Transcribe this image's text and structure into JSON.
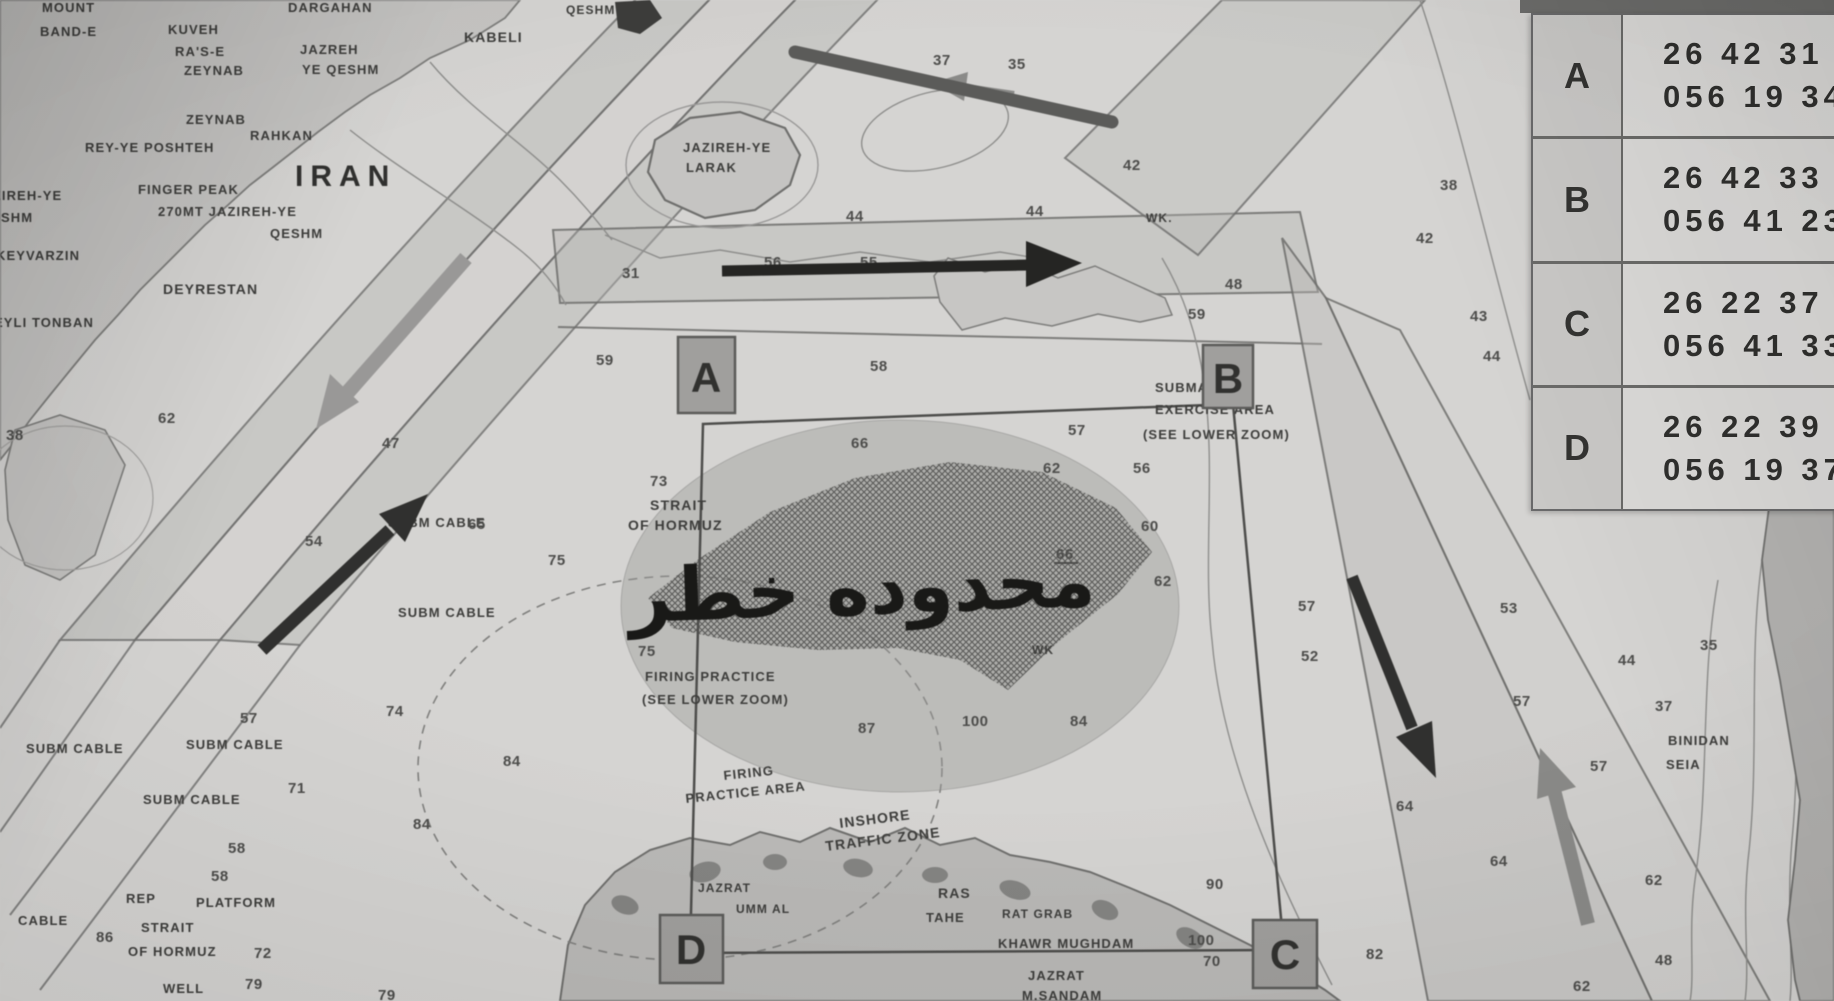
{
  "meta": {
    "description": "Photographed nautical chart, Strait of Hormuz, with danger-area overlay and coordinate table"
  },
  "coordinate_table": {
    "rows": [
      {
        "point": "A",
        "line1": "26 42 31",
        "line2": "056 19 34"
      },
      {
        "point": "B",
        "line1": "26 42 33",
        "line2": "056 41 23"
      },
      {
        "point": "C",
        "line1": "26 22 37",
        "line2": "056 41 33"
      },
      {
        "point": "D",
        "line1": "26 22 39",
        "line2": "056 19 37"
      }
    ]
  },
  "map": {
    "danger_text": "محدوده خطر",
    "corner_markers": [
      {
        "letter": "A"
      },
      {
        "letter": "B"
      },
      {
        "letter": "C"
      },
      {
        "letter": "D"
      }
    ],
    "place_labels": [
      {
        "t": "MOUNT",
        "x": 42,
        "y": 12,
        "s": 13
      },
      {
        "t": "BAND-E",
        "x": 40,
        "y": 36,
        "s": 13
      },
      {
        "t": "DARGAHAN",
        "x": 288,
        "y": 12,
        "s": 13
      },
      {
        "t": "KUVEH",
        "x": 168,
        "y": 34,
        "s": 13
      },
      {
        "t": "RA'S-E",
        "x": 175,
        "y": 56,
        "s": 13
      },
      {
        "t": "ZEYNAB",
        "x": 184,
        "y": 75,
        "s": 13
      },
      {
        "t": "JAZREH",
        "x": 300,
        "y": 54,
        "s": 13
      },
      {
        "t": "YE QESHM",
        "x": 302,
        "y": 74,
        "s": 13
      },
      {
        "t": "KABELI",
        "x": 464,
        "y": 42,
        "s": 14
      },
      {
        "t": "QESHM",
        "x": 566,
        "y": 14,
        "s": 12
      },
      {
        "t": "ZEYNAB",
        "x": 186,
        "y": 124,
        "s": 13
      },
      {
        "t": "RAHKAN",
        "x": 250,
        "y": 140,
        "s": 13
      },
      {
        "t": "REY-YE POSHTEH",
        "x": 85,
        "y": 152,
        "s": 13
      },
      {
        "t": "IRAN",
        "x": 295,
        "y": 186,
        "s": 30,
        "ls": 7,
        "b": 1
      },
      {
        "t": "FINGER PEAK",
        "x": 138,
        "y": 194,
        "s": 13
      },
      {
        "t": "270MT  JAZIREH-YE",
        "x": 158,
        "y": 216,
        "s": 13
      },
      {
        "t": "QESHM",
        "x": 270,
        "y": 238,
        "s": 13
      },
      {
        "t": "JAZIREH-YE",
        "x": -26,
        "y": 200,
        "s": 13
      },
      {
        "t": "QESHM",
        "x": -20,
        "y": 222,
        "s": 13
      },
      {
        "t": "KEYVARZIN",
        "x": -4,
        "y": 260,
        "s": 13
      },
      {
        "t": "DEYRESTAN",
        "x": 163,
        "y": 294,
        "s": 14
      },
      {
        "t": "EYLI TONBAN",
        "x": -6,
        "y": 327,
        "s": 13
      },
      {
        "t": "JAZIREH-YE",
        "x": 683,
        "y": 152,
        "s": 13
      },
      {
        "t": "LARAK",
        "x": 686,
        "y": 172,
        "s": 13
      },
      {
        "t": "STRAIT",
        "x": 650,
        "y": 510,
        "s": 14
      },
      {
        "t": "OF HORMUZ",
        "x": 628,
        "y": 530,
        "s": 14
      },
      {
        "t": "SUBM CABLE",
        "x": 388,
        "y": 527,
        "s": 13
      },
      {
        "t": "FIRING PRACTICE",
        "x": 645,
        "y": 681,
        "s": 13
      },
      {
        "t": "(SEE LOWER ZOOM)",
        "x": 642,
        "y": 704,
        "s": 13
      },
      {
        "t": "SUBM CABLE",
        "x": 398,
        "y": 617,
        "s": 13
      },
      {
        "t": "SUBM CABLE",
        "x": 26,
        "y": 753,
        "s": 13
      },
      {
        "t": "SUBM CABLE",
        "x": 186,
        "y": 749,
        "s": 13
      },
      {
        "t": "SUBM CABLE",
        "x": 143,
        "y": 804,
        "s": 13
      },
      {
        "t": "FIRING",
        "x": 724,
        "y": 780,
        "s": 13,
        "r": -6
      },
      {
        "t": "PRACTICE AREA",
        "x": 686,
        "y": 803,
        "s": 13,
        "r": -6
      },
      {
        "t": "INSHORE",
        "x": 840,
        "y": 828,
        "s": 14,
        "r": -7
      },
      {
        "t": "TRAFFIC ZONE",
        "x": 826,
        "y": 851,
        "s": 14,
        "r": -7
      },
      {
        "t": "SUBMARINE",
        "x": 1155,
        "y": 392,
        "s": 13
      },
      {
        "t": "EXERCISE AREA",
        "x": 1155,
        "y": 414,
        "s": 13
      },
      {
        "t": "(SEE LOWER ZOOM)",
        "x": 1143,
        "y": 439,
        "s": 13
      },
      {
        "t": "JAZRAT",
        "x": 698,
        "y": 892,
        "s": 12
      },
      {
        "t": "UMM AL",
        "x": 736,
        "y": 913,
        "s": 12
      },
      {
        "t": "RAS",
        "x": 938,
        "y": 898,
        "s": 14
      },
      {
        "t": "TAHE",
        "x": 926,
        "y": 922,
        "s": 13
      },
      {
        "t": "RAT GRAB",
        "x": 1002,
        "y": 918,
        "s": 12
      },
      {
        "t": "KHAWR MUGHDAM",
        "x": 998,
        "y": 948,
        "s": 13
      },
      {
        "t": "JAZRAT",
        "x": 1028,
        "y": 980,
        "s": 13
      },
      {
        "t": "M.SANDAM",
        "x": 1022,
        "y": 1000,
        "s": 13
      },
      {
        "t": "REP",
        "x": 126,
        "y": 903,
        "s": 13
      },
      {
        "t": "PLATFORM",
        "x": 196,
        "y": 907,
        "s": 13
      },
      {
        "t": "STRAIT",
        "x": 141,
        "y": 932,
        "s": 13
      },
      {
        "t": "OF HORMUZ",
        "x": 128,
        "y": 956,
        "s": 13
      },
      {
        "t": "WELL",
        "x": 163,
        "y": 993,
        "s": 13
      },
      {
        "t": "CABLE",
        "x": 18,
        "y": 925,
        "s": 13
      },
      {
        "t": "BINIDAN",
        "x": 1668,
        "y": 745,
        "s": 13
      },
      {
        "t": "SEIA",
        "x": 1666,
        "y": 769,
        "s": 13
      },
      {
        "t": "WK.",
        "x": 1146,
        "y": 222,
        "s": 12
      },
      {
        "t": "WK",
        "x": 1032,
        "y": 654,
        "s": 12
      }
    ],
    "soundings": [
      {
        "v": "38",
        "x": 6,
        "y": 440
      },
      {
        "v": "62",
        "x": 158,
        "y": 423
      },
      {
        "v": "47",
        "x": 382,
        "y": 448
      },
      {
        "v": "54",
        "x": 305,
        "y": 546
      },
      {
        "v": "65",
        "x": 468,
        "y": 529
      },
      {
        "v": "57",
        "x": 240,
        "y": 723
      },
      {
        "v": "74",
        "x": 386,
        "y": 716
      },
      {
        "v": "71",
        "x": 288,
        "y": 793
      },
      {
        "v": "84",
        "x": 413,
        "y": 829
      },
      {
        "v": "84",
        "x": 503,
        "y": 766
      },
      {
        "v": "58",
        "x": 228,
        "y": 853
      },
      {
        "v": "58",
        "x": 211,
        "y": 881
      },
      {
        "v": "86",
        "x": 96,
        "y": 942
      },
      {
        "v": "72",
        "x": 254,
        "y": 958
      },
      {
        "v": "79",
        "x": 245,
        "y": 989
      },
      {
        "v": "79",
        "x": 378,
        "y": 1000
      },
      {
        "v": "75",
        "x": 548,
        "y": 565
      },
      {
        "v": "75",
        "x": 638,
        "y": 656
      },
      {
        "v": "73",
        "x": 650,
        "y": 486
      },
      {
        "v": "31",
        "x": 622,
        "y": 278
      },
      {
        "v": "59",
        "x": 596,
        "y": 365
      },
      {
        "v": "55",
        "x": 860,
        "y": 267
      },
      {
        "v": "56",
        "x": 764,
        "y": 267
      },
      {
        "v": "58",
        "x": 870,
        "y": 371
      },
      {
        "v": "66",
        "x": 851,
        "y": 448
      },
      {
        "v": "66",
        "x": 1056,
        "y": 559,
        "u": true
      },
      {
        "v": "62",
        "x": 1043,
        "y": 473
      },
      {
        "v": "57",
        "x": 1068,
        "y": 435
      },
      {
        "v": "56",
        "x": 1133,
        "y": 473
      },
      {
        "v": "60",
        "x": 1141,
        "y": 531
      },
      {
        "v": "62",
        "x": 1154,
        "y": 586
      },
      {
        "v": "57",
        "x": 1298,
        "y": 611
      },
      {
        "v": "52",
        "x": 1301,
        "y": 661
      },
      {
        "v": "87",
        "x": 858,
        "y": 733
      },
      {
        "v": "100",
        "x": 962,
        "y": 726
      },
      {
        "v": "84",
        "x": 1070,
        "y": 726
      },
      {
        "v": "90",
        "x": 1206,
        "y": 889
      },
      {
        "v": "100",
        "x": 1188,
        "y": 945
      },
      {
        "v": "70",
        "x": 1203,
        "y": 966
      },
      {
        "v": "82",
        "x": 1366,
        "y": 959
      },
      {
        "v": "44",
        "x": 1026,
        "y": 216
      },
      {
        "v": "42",
        "x": 1123,
        "y": 170
      },
      {
        "v": "37",
        "x": 933,
        "y": 65
      },
      {
        "v": "35",
        "x": 1008,
        "y": 69
      },
      {
        "v": "38",
        "x": 1440,
        "y": 190
      },
      {
        "v": "42",
        "x": 1416,
        "y": 243
      },
      {
        "v": "43",
        "x": 1470,
        "y": 321
      },
      {
        "v": "44",
        "x": 1483,
        "y": 361
      },
      {
        "v": "48",
        "x": 1225,
        "y": 289
      },
      {
        "v": "59",
        "x": 1188,
        "y": 319
      },
      {
        "v": "53",
        "x": 1500,
        "y": 613
      },
      {
        "v": "57",
        "x": 1513,
        "y": 706
      },
      {
        "v": "57",
        "x": 1590,
        "y": 771
      },
      {
        "v": "44",
        "x": 1618,
        "y": 665
      },
      {
        "v": "37",
        "x": 1655,
        "y": 711
      },
      {
        "v": "35",
        "x": 1700,
        "y": 650
      },
      {
        "v": "62",
        "x": 1645,
        "y": 885
      },
      {
        "v": "48",
        "x": 1655,
        "y": 965
      },
      {
        "v": "62",
        "x": 1573,
        "y": 991
      },
      {
        "v": "64",
        "x": 1396,
        "y": 811
      },
      {
        "v": "64",
        "x": 1490,
        "y": 866
      },
      {
        "v": "44",
        "x": 846,
        "y": 221
      }
    ]
  }
}
